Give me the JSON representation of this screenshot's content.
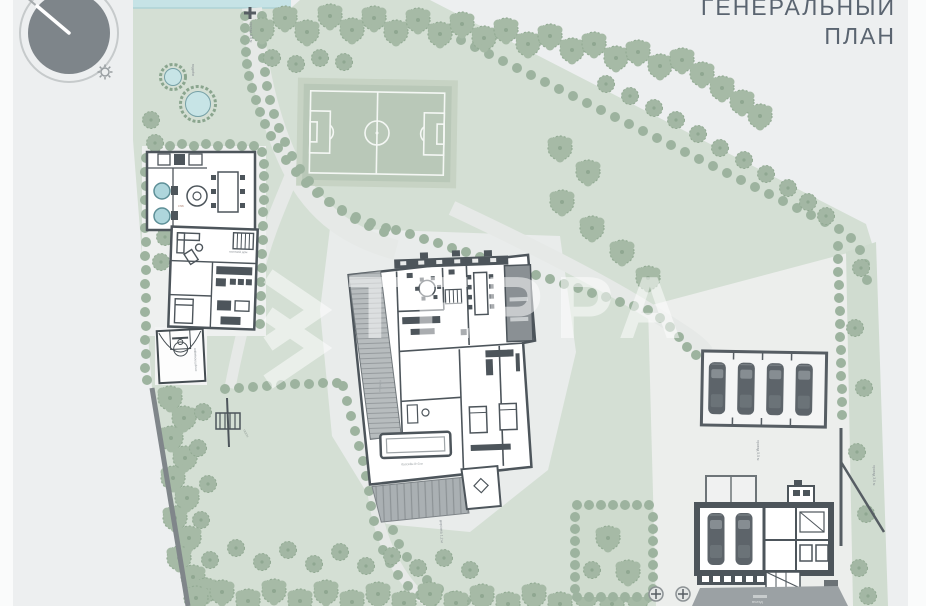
{
  "title": {
    "line1": "ГЕНЕРАЛЬНЫЙ",
    "line2": "ПЛАН"
  },
  "watermark": {
    "brand": "ТЕРРА"
  },
  "labels": {
    "top_road": "проезд 3,5 м",
    "pond": "водоём",
    "court": "спортплощадка",
    "lawn": "газон",
    "walk": "дорожка 1,2 м",
    "side_road": "проезд 5,5 м",
    "right_road": "проезд 3,5 м",
    "entry": "въезд",
    "guest_house": "гостевой дом",
    "spa": "спа",
    "pool": "бассейн 8×3 м",
    "terrace": "терраса"
  },
  "icons": {
    "compass": "north-arrow-sun-diagram",
    "sun": "sun-icon"
  },
  "colors": {
    "background": "#edeff0",
    "lawn": "#d4dfd4",
    "soccer_field": "#b9c8b8",
    "tree": "#a6baa6",
    "bush": "#9db39f",
    "water": "#c6e3e6",
    "building_wall": "#4d555b",
    "hardscape": "#e9eceb",
    "car": "#5d646a",
    "title_text": "#5a6470",
    "watermark_white": "#ffffff"
  }
}
